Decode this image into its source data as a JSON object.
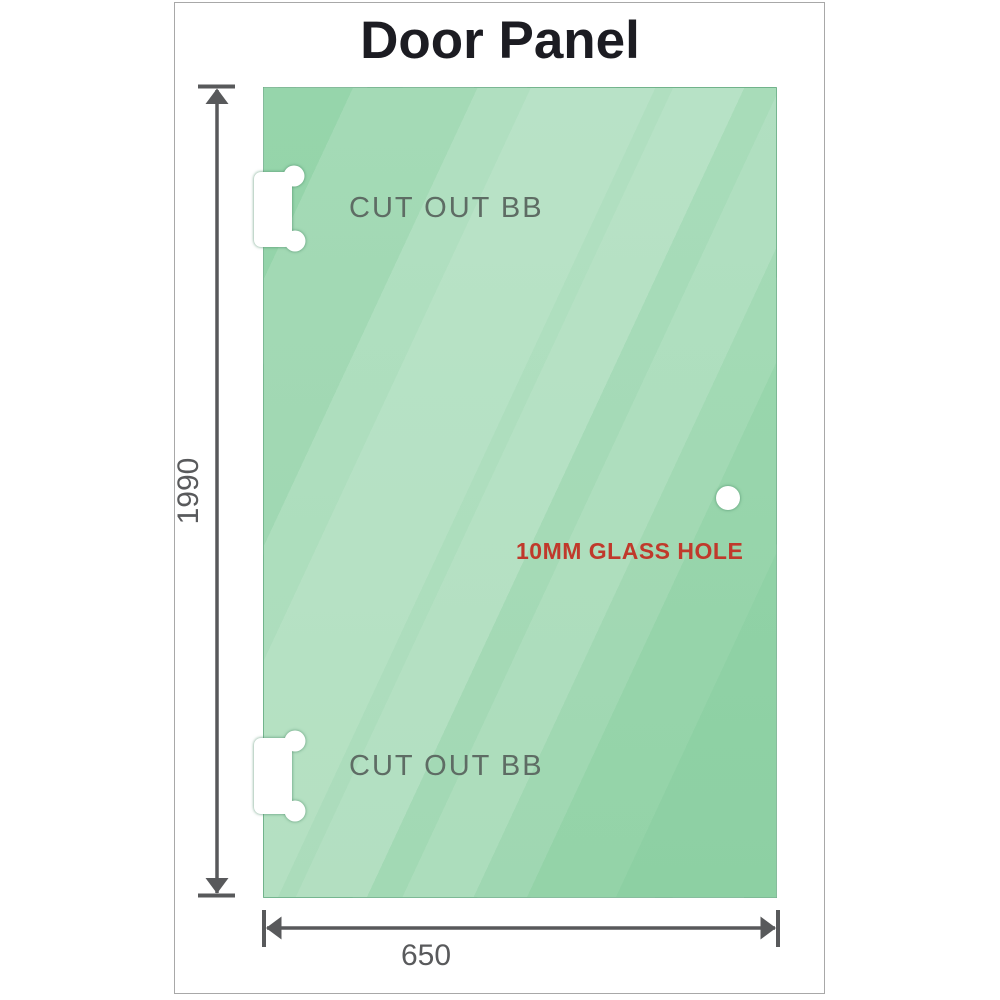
{
  "title": "Door Panel",
  "panel": {
    "top_cutout_label": "CUT OUT BB",
    "bottom_cutout_label": "CUT OUT BB",
    "glass_hole_label": "10MM GLASS HOLE"
  },
  "dimensions": {
    "height_mm": "1990",
    "width_mm": "650"
  },
  "colors": {
    "glass_green": "#8ccfa2",
    "dimension_gray": "#58595b",
    "hole_label_red": "#c0392b",
    "cutout_label_gray": "#5e6c64",
    "title_color": "#1c1c22",
    "frame_border": "#a8a8a8"
  }
}
